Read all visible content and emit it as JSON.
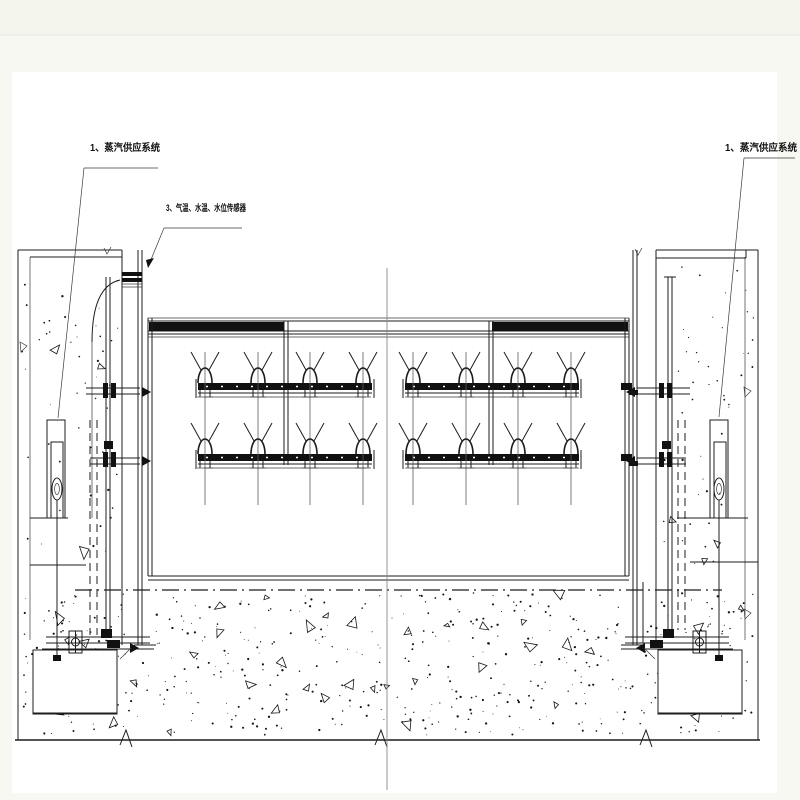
{
  "page": {
    "background": "#f7f8f1",
    "sheet_background": "#ffffff",
    "top_band_divider_y": 35
  },
  "colors": {
    "line": "#1c1c1c",
    "centerline": "#8a8a8a",
    "axis_line": "#5c5c5c",
    "label_text": "#111111"
  },
  "labels": {
    "steam_supply_left": "1、蒸汽供应系统",
    "sensors": "3、气温、水温、水位传感器",
    "steam_supply_right": "1、蒸汽供应系统"
  }
}
